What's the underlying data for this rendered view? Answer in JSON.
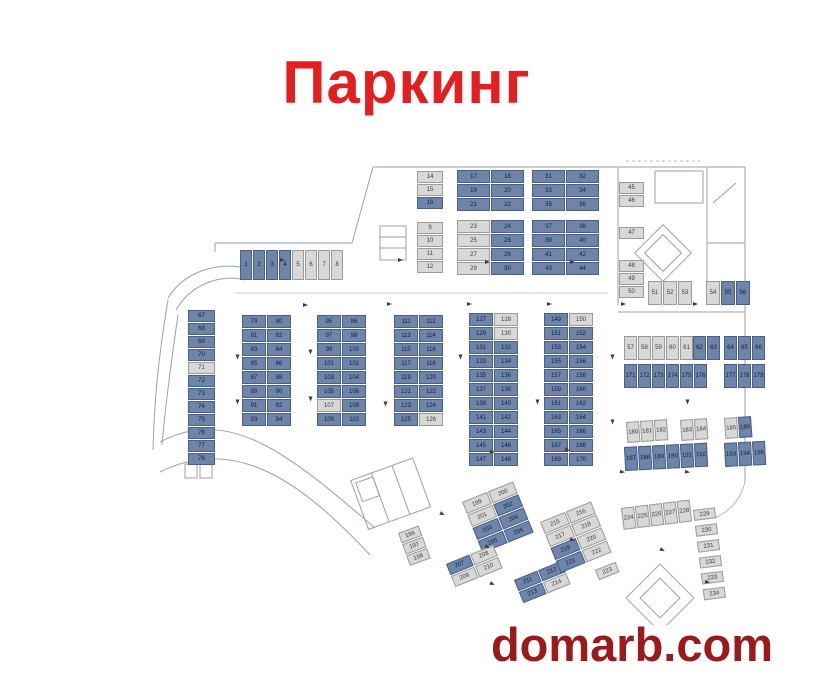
{
  "title": {
    "text": "Паркинг"
  },
  "watermark": {
    "text": "domarb.com"
  },
  "colors": {
    "title_red": "#e41f1f",
    "watermark_maroon": "#9a1b1b",
    "occupied_blue": "#6e84a9",
    "free_gray": "#d8d8d6",
    "walls": "#9aa2ac"
  },
  "plan": {
    "groups": [
      {
        "name": "entry-strip",
        "x": 100,
        "y": 100,
        "cols": 8,
        "cellW": 12,
        "cellH": 30,
        "rot": 0,
        "cells": [
          "1b",
          "2b",
          "3b",
          "4b",
          "5g",
          "6g",
          "7g",
          "8g"
        ]
      },
      {
        "name": "top-col-lower",
        "x": 277,
        "y": 72,
        "cols": 1,
        "cellW": 26,
        "cellH": 12,
        "rot": 0,
        "cells": [
          "9g",
          "10g",
          "11g",
          "12g"
        ]
      },
      {
        "name": "top-col-upper",
        "x": 277,
        "y": 21,
        "cols": 1,
        "cellW": 26,
        "cellH": 12,
        "rot": 0,
        "cells": [
          "14g",
          "15g",
          "16b"
        ]
      },
      {
        "name": "top-a-upper",
        "x": 317,
        "y": 20,
        "cols": 2,
        "cellW": 33,
        "cellH": 13,
        "rot": 0,
        "cells": [
          "17b",
          "18b",
          "19b",
          "20b",
          "21b",
          "22b"
        ]
      },
      {
        "name": "top-a-lower",
        "x": 317,
        "y": 70,
        "cols": 2,
        "cellW": 33,
        "cellH": 13,
        "rot": 0,
        "cells": [
          "23g",
          "24b",
          "25g",
          "26b",
          "27g",
          "28b",
          "29g",
          "30b"
        ]
      },
      {
        "name": "top-b-upper",
        "x": 392,
        "y": 20,
        "cols": 2,
        "cellW": 33,
        "cellH": 13,
        "rot": 0,
        "cells": [
          "31b",
          "32b",
          "33b",
          "34b",
          "35b",
          "36b"
        ]
      },
      {
        "name": "top-b-lower",
        "x": 392,
        "y": 70,
        "cols": 2,
        "cellW": 33,
        "cellH": 13,
        "rot": 0,
        "cells": [
          "37b",
          "38b",
          "39b",
          "40b",
          "41b",
          "42b",
          "43b",
          "44b"
        ]
      },
      {
        "name": "right-col-a",
        "x": 479,
        "y": 32,
        "cols": 1,
        "cellW": 25,
        "cellH": 12,
        "rot": 0,
        "cells": [
          "45g",
          "46g"
        ]
      },
      {
        "name": "right-col-b",
        "x": 479,
        "y": 77,
        "cols": 1,
        "cellW": 25,
        "cellH": 12,
        "rot": 0,
        "cells": [
          "47g"
        ]
      },
      {
        "name": "right-col-c",
        "x": 479,
        "y": 110,
        "cols": 1,
        "cellW": 25,
        "cellH": 12,
        "rot": 0,
        "cells": [
          "48g",
          "49g",
          "50g"
        ]
      },
      {
        "name": "right-row-a",
        "x": 508,
        "y": 131,
        "cols": 3,
        "cellW": 14,
        "cellH": 24,
        "rot": 0,
        "cells": [
          "51g",
          "52g",
          "53g"
        ]
      },
      {
        "name": "right-row-b",
        "x": 566,
        "y": 131,
        "cols": 3,
        "cellW": 14,
        "cellH": 24,
        "rot": 0,
        "cells": [
          "54g",
          "55b",
          "56b"
        ]
      },
      {
        "name": "mid-left-col",
        "x": 48,
        "y": 160,
        "cols": 1,
        "cellW": 27,
        "cellH": 12,
        "rot": 0,
        "cells": [
          "67b",
          "68b",
          "69b",
          "70b",
          "71g",
          "72b",
          "73b",
          "74b",
          "75b",
          "76b",
          "77b",
          "78b"
        ]
      },
      {
        "name": "mid-grp-1",
        "x": 102,
        "y": 165,
        "cols": 2,
        "cellW": 24,
        "cellH": 13,
        "rot": 0,
        "cells": [
          "79b",
          "80b",
          "81b",
          "82b",
          "83b",
          "84b",
          "85b",
          "86b",
          "87b",
          "88b",
          "89b",
          "90b",
          "91b",
          "92b",
          "93b",
          "94b"
        ]
      },
      {
        "name": "mid-grp-2",
        "x": 177,
        "y": 165,
        "cols": 2,
        "cellW": 24,
        "cellH": 13,
        "rot": 0,
        "cells": [
          "95b",
          "96b",
          "97b",
          "98b",
          "99b",
          "100b",
          "101b",
          "102b",
          "103b",
          "104b",
          "105b",
          "106b",
          "107g",
          "108b",
          "109b",
          "110b"
        ]
      },
      {
        "name": "mid-grp-3",
        "x": 254,
        "y": 165,
        "cols": 2,
        "cellW": 24,
        "cellH": 13,
        "rot": 0,
        "cells": [
          "111b",
          "112b",
          "113b",
          "114b",
          "115b",
          "116b",
          "117b",
          "118b",
          "119b",
          "120b",
          "121b",
          "122b",
          "123b",
          "124b",
          "125b",
          "126g"
        ]
      },
      {
        "name": "mid-grp-4",
        "x": 329,
        "y": 163,
        "cols": 2,
        "cellW": 24,
        "cellH": 13,
        "rot": 0,
        "cells": [
          "127b",
          "128g",
          "129b",
          "130g",
          "131b",
          "132b",
          "133b",
          "134b",
          "135b",
          "136b",
          "137b",
          "138b",
          "139b",
          "140b",
          "141b",
          "142b",
          "143b",
          "144b",
          "145b",
          "146b",
          "147b",
          "148b"
        ]
      },
      {
        "name": "mid-grp-5",
        "x": 404,
        "y": 163,
        "cols": 2,
        "cellW": 24,
        "cellH": 13,
        "rot": 0,
        "cells": [
          "149b",
          "150g",
          "151b",
          "152b",
          "153b",
          "154b",
          "155b",
          "156b",
          "157b",
          "158b",
          "159b",
          "160b",
          "161b",
          "162b",
          "163b",
          "164b",
          "165b",
          "166b",
          "167b",
          "168b",
          "169b",
          "170b"
        ]
      },
      {
        "name": "band1-gray",
        "x": 484,
        "y": 186,
        "cols": 5,
        "cellW": 13,
        "cellH": 24,
        "rot": 0,
        "cells": [
          "57g",
          "58g",
          "59g",
          "60g",
          "61g"
        ]
      },
      {
        "name": "band1-pair",
        "x": 553,
        "y": 186,
        "cols": 2,
        "cellW": 13,
        "cellH": 24,
        "rot": 0,
        "cells": [
          "62b",
          "63b"
        ]
      },
      {
        "name": "band1-trio",
        "x": 584,
        "y": 186,
        "cols": 3,
        "cellW": 13,
        "cellH": 24,
        "rot": 0,
        "cells": [
          "64b",
          "65b",
          "66b"
        ]
      },
      {
        "name": "band2-six",
        "x": 484,
        "y": 214,
        "cols": 6,
        "cellW": 13,
        "cellH": 24,
        "rot": 0,
        "cells": [
          "171b",
          "172b",
          "173b",
          "174b",
          "175b",
          "176b"
        ]
      },
      {
        "name": "band2-trio",
        "x": 584,
        "y": 214,
        "cols": 3,
        "cellW": 13,
        "cellH": 24,
        "rot": 0,
        "cells": [
          "177b",
          "178b",
          "179b"
        ]
      },
      {
        "name": "band3-a",
        "x": 486,
        "y": 272,
        "cols": 3,
        "cellW": 13,
        "cellH": 21,
        "rot": -4,
        "cells": [
          "180g",
          "181g",
          "182g"
        ]
      },
      {
        "name": "band3-b",
        "x": 540,
        "y": 270,
        "cols": 2,
        "cellW": 13,
        "cellH": 21,
        "rot": -4,
        "cells": [
          "183g",
          "184g"
        ]
      },
      {
        "name": "band3-c",
        "x": 584,
        "y": 268,
        "cols": 2,
        "cellW": 13,
        "cellH": 21,
        "rot": -4,
        "cells": [
          "185g",
          "186b"
        ]
      },
      {
        "name": "band4-six",
        "x": 484,
        "y": 297,
        "cols": 6,
        "cellW": 13,
        "cellH": 24,
        "rot": -3,
        "cells": [
          "187b",
          "188b",
          "189b",
          "190b",
          "191b",
          "192b"
        ]
      },
      {
        "name": "band4-trio",
        "x": 584,
        "y": 293,
        "cols": 3,
        "cellW": 13,
        "cellH": 24,
        "rot": -3,
        "cells": [
          "193b",
          "194b",
          "195b"
        ]
      },
      {
        "name": "low-gray-trio",
        "x": 258,
        "y": 383,
        "cols": 1,
        "cellW": 22,
        "cellH": 11,
        "rot": -20,
        "cells": [
          "196g",
          "197g",
          "198g"
        ]
      },
      {
        "name": "diag-1",
        "x": 322,
        "y": 352,
        "cols": 2,
        "cellW": 27,
        "cellH": 13,
        "rot": -22,
        "cells": [
          "199g",
          "200g",
          "201g",
          "202b",
          "203b",
          "204b",
          "205b",
          "206b"
        ]
      },
      {
        "name": "diag-2",
        "x": 306,
        "y": 414,
        "cols": 2,
        "cellW": 25,
        "cellH": 12,
        "rot": -22,
        "cells": [
          "207b",
          "208g",
          "209g",
          "210g"
        ]
      },
      {
        "name": "diag-3",
        "x": 374,
        "y": 430,
        "cols": 2,
        "cellW": 25,
        "cellH": 12,
        "rot": -22,
        "cells": [
          "211b",
          "212b",
          "213b",
          "214g"
        ]
      },
      {
        "name": "diag-4",
        "x": 400,
        "y": 372,
        "cols": 2,
        "cellW": 27,
        "cellH": 13,
        "rot": -22,
        "cells": [
          "215g",
          "216g",
          "217g",
          "218g",
          "219b",
          "220g",
          "221b",
          "222g"
        ]
      },
      {
        "name": "diag-single",
        "x": 455,
        "y": 420,
        "cols": 1,
        "cellW": 22,
        "cellH": 11,
        "rot": -22,
        "cells": [
          "223g"
        ]
      },
      {
        "name": "br-row",
        "x": 481,
        "y": 358,
        "cols": 5,
        "cellW": 13,
        "cellH": 22,
        "rot": -7,
        "cells": [
          "224g",
          "225g",
          "226g",
          "227g",
          "228g"
        ]
      },
      {
        "name": "br-col",
        "x": 553,
        "y": 360,
        "cols": 1,
        "cellW": 22,
        "cellH": 11,
        "rot": -7,
        "gapY": 5,
        "cells": [
          "229g",
          "230g",
          "231g",
          "232g",
          "233g",
          "234g"
        ]
      }
    ],
    "arrows": [
      {
        "x": 163,
        "y": 153,
        "r": 0
      },
      {
        "x": 247,
        "y": 152,
        "r": 0
      },
      {
        "x": 327,
        "y": 152,
        "r": 0
      },
      {
        "x": 407,
        "y": 152,
        "r": 0
      },
      {
        "x": 481,
        "y": 152,
        "r": 0
      },
      {
        "x": 553,
        "y": 152,
        "r": 0
      },
      {
        "x": 95,
        "y": 205,
        "r": 90
      },
      {
        "x": 95,
        "y": 250,
        "r": 90
      },
      {
        "x": 168,
        "y": 200,
        "r": 90
      },
      {
        "x": 168,
        "y": 247,
        "r": 90
      },
      {
        "x": 243,
        "y": 252,
        "r": 90
      },
      {
        "x": 318,
        "y": 205,
        "r": 90
      },
      {
        "x": 395,
        "y": 250,
        "r": 90
      },
      {
        "x": 470,
        "y": 205,
        "r": 90
      },
      {
        "x": 545,
        "y": 250,
        "r": 90
      },
      {
        "x": 140,
        "y": 108,
        "r": 0
      },
      {
        "x": 258,
        "y": 108,
        "r": 0
      },
      {
        "x": 345,
        "y": 110,
        "r": 0
      },
      {
        "x": 430,
        "y": 110,
        "r": 0
      },
      {
        "x": 350,
        "y": 300,
        "r": 20
      },
      {
        "x": 425,
        "y": 298,
        "r": 15
      },
      {
        "x": 480,
        "y": 320,
        "r": 10
      },
      {
        "x": 545,
        "y": 320,
        "r": 10
      },
      {
        "x": 300,
        "y": 362,
        "r": 25
      },
      {
        "x": 345,
        "y": 395,
        "r": 25
      },
      {
        "x": 430,
        "y": 388,
        "r": 25
      },
      {
        "x": 520,
        "y": 398,
        "r": 25
      },
      {
        "x": 350,
        "y": 432,
        "r": 25
      },
      {
        "x": 565,
        "y": 430,
        "r": 10
      },
      {
        "x": 470,
        "y": 270,
        "r": 90
      }
    ]
  }
}
